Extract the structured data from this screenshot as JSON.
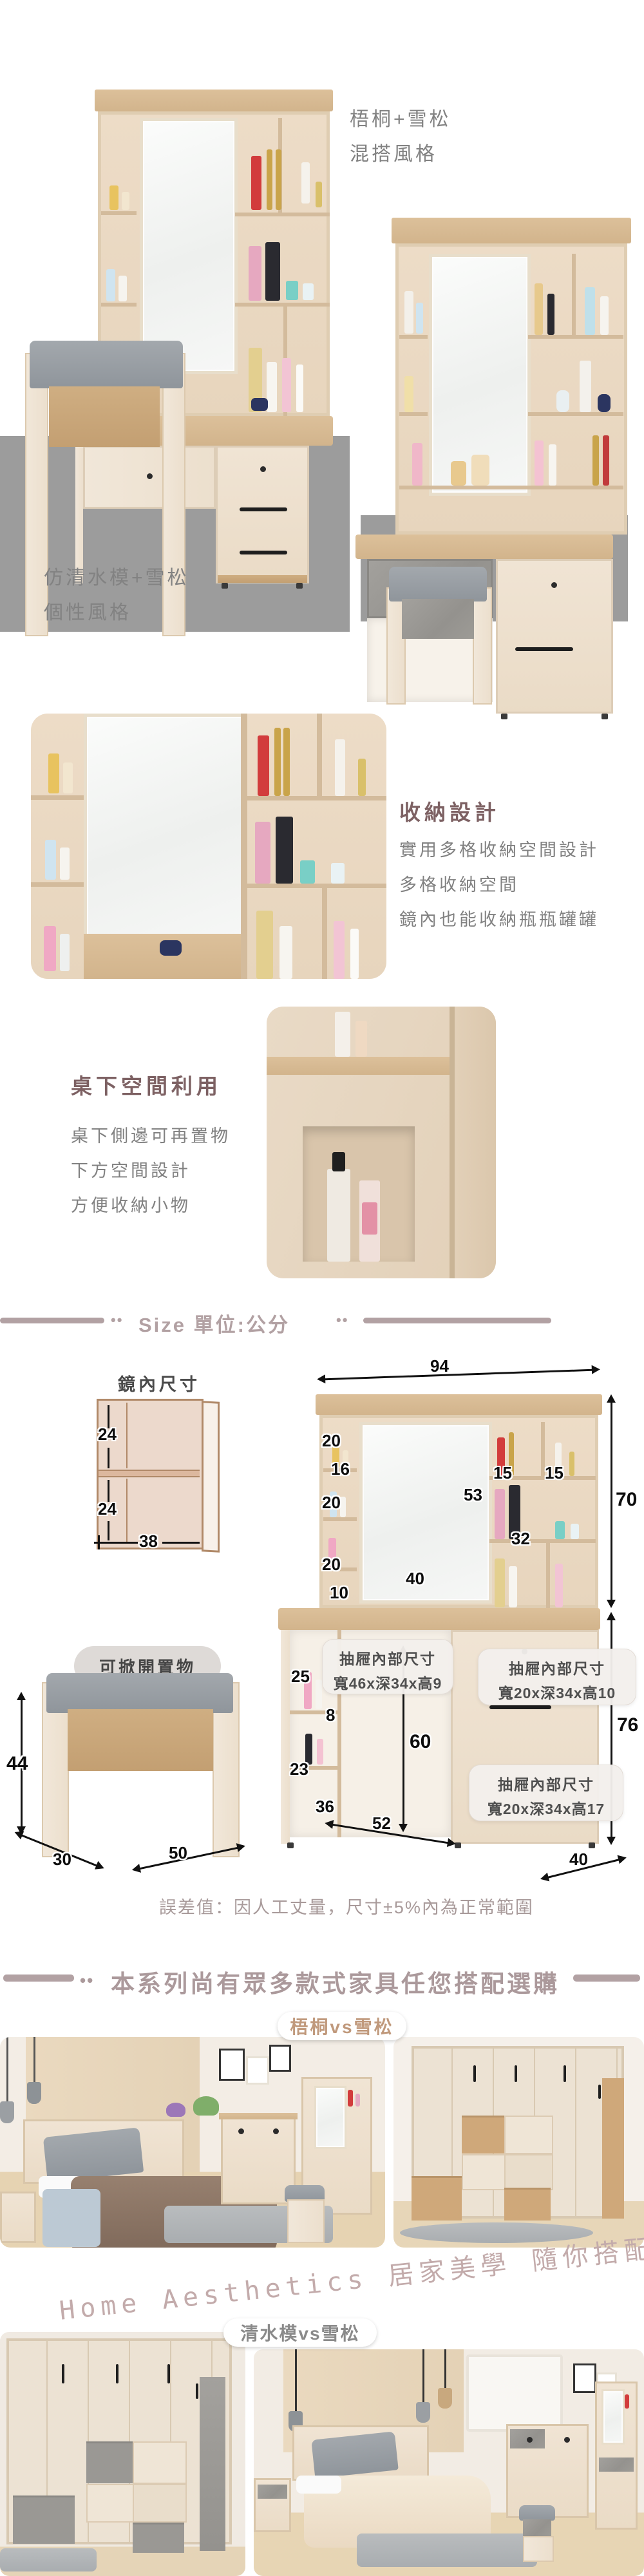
{
  "hero": {
    "style_a_line1": "梧桐+雪松",
    "style_a_line2": "混搭風格",
    "style_b_line1": "仿清水模+雪松",
    "style_b_line2": "個性風格"
  },
  "feature_storage": {
    "title": "收納設計",
    "line1": "實用多格收納空間設計",
    "line2": "多格收納空間",
    "line3": "鏡內也能收納瓶瓶罐罐"
  },
  "feature_underdesk": {
    "title": "桌下空間利用",
    "line1": "桌下側邊可再置物",
    "line2": "下方空間設計",
    "line3": "方便收納小物"
  },
  "size": {
    "dots": "••",
    "header": "Size 單位:公分",
    "mirror_inner": {
      "title": "鏡內尺寸",
      "upper_height": "24",
      "lower_height": "24",
      "width": "38"
    },
    "hutch": {
      "width": "94",
      "height": "70",
      "cell1": "20",
      "cell2": "16",
      "cell3": "20",
      "cell4": "20",
      "cell5": "10",
      "right_cell1": "15",
      "right_cell2": "15",
      "mirror_height": "53",
      "shelf_width": "32",
      "mirror_width": "40"
    },
    "desk": {
      "open_upper": "25",
      "gap": "8",
      "open_lower": "23",
      "open_width": "36",
      "knee_height": "60",
      "width": "52",
      "height": "76",
      "depth": "40"
    },
    "stool": {
      "callout": "可掀開置物",
      "height": "44",
      "depth": "30",
      "width": "50"
    },
    "callout1_line1": "抽屜內部尺寸",
    "callout1_line2": "寬46x深34x高9",
    "callout2_line1": "抽屜內部尺寸",
    "callout2_line2": "寬20x深34x高10",
    "callout3_line1": "抽屜內部尺寸",
    "callout3_line2": "寬20x深34x高17",
    "tolerance": "誤差值：因人工丈量，尺寸±5%內為正常範圍"
  },
  "series": {
    "dots": "••",
    "header": "本系列尚有眾多款式家具任您搭配選購",
    "pill_a": "梧桐vs雪松",
    "tagline": "Home Aesthetics 居家美學 隨你搭配",
    "pill_b": "清水模vs雪松"
  },
  "colors": {
    "accent_title": "#7d6163",
    "header_mauve": "#b2a1a3",
    "script_pink": "#c3abab",
    "pill_a_text": "#c0997c",
    "pill_b_text": "#8a8a8a",
    "body_gray": "#828282",
    "backdrop_gray": "#9c9c9c"
  }
}
